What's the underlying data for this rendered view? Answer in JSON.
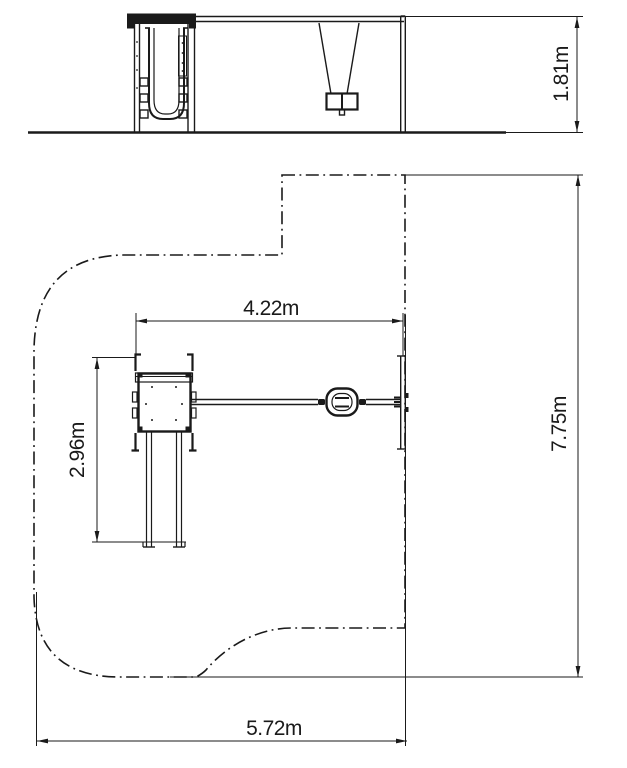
{
  "style": {
    "background": "#ffffff",
    "line_color": "#1a1a1a"
  },
  "drawing": {
    "kind": "playground-equipment-dimensional-drawing",
    "unit": "m",
    "views": [
      {
        "id": "elevation",
        "name": "side elevation of tower, slide and swing"
      },
      {
        "id": "plan",
        "name": "top plan view with safety zone outline"
      }
    ],
    "dimensions": {
      "height": {
        "label": "1.81m",
        "value": 1.81,
        "unit": "m",
        "orientation": "vertical",
        "view": "elevation"
      },
      "span": {
        "label": "4.22m",
        "value": 4.22,
        "unit": "m",
        "orientation": "horizontal",
        "view": "plan"
      },
      "depth": {
        "label": "2.96m",
        "value": 2.96,
        "unit": "m",
        "orientation": "vertical",
        "view": "plan"
      },
      "zone_length": {
        "label": "7.75m",
        "value": 7.75,
        "unit": "m",
        "orientation": "vertical",
        "view": "plan"
      },
      "zone_width": {
        "label": "5.72m",
        "value": 5.72,
        "unit": "m",
        "orientation": "horizontal",
        "view": "plan"
      }
    }
  }
}
